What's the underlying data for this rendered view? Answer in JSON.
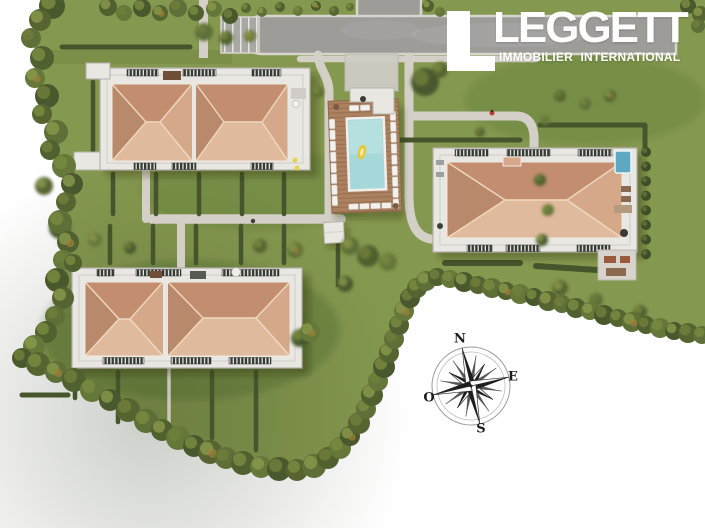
{
  "brand": {
    "title": "LEGGETT",
    "subtitle": "IMMOBILIER INTERNATIONAL"
  },
  "compass": {
    "north": "N",
    "east": "E",
    "south": "S",
    "west": "O"
  },
  "scene": {
    "type": "aerial-3d-architectural-site-plan",
    "features": [
      "apartment-building-northwest",
      "apartment-building-east",
      "apartment-building-southwest",
      "swimming-pool",
      "pool-deck-with-sun-loungers",
      "pool-float",
      "access-road",
      "parking-bays",
      "footpath-network",
      "private-gardens-with-hedges",
      "tree-border",
      "rooftop-terraces-with-railings",
      "cypress-row",
      "compass-rose"
    ]
  },
  "colors": {
    "lawn": "#85984f",
    "lawn_dark": "#6f8242",
    "tree_dark": "#4a592d",
    "tree_mid": "#5d6d35",
    "tree_light": "#79893f",
    "hedge": "#46552b",
    "road": "#9d9c99",
    "curb": "#d8d5cf",
    "path": "#d4d0c7",
    "terrace": "#e9e7e2",
    "terrace_edge": "#b2afaa",
    "railing": "#373d36",
    "roof_north": "#c28e6f",
    "roof_south": "#e0ba9c",
    "roof_east": "#d4a888",
    "roof_west": "#b9896b",
    "roof_ridge": "#f0d8bf",
    "deck": "#ac8160",
    "pool": "#a6d7d9",
    "pool_light": "#c2e6e6",
    "spa": "#5fa8c4",
    "lounger": "#f2f1ed",
    "logo": "#ffffff",
    "ink": "#1e1e1e"
  }
}
